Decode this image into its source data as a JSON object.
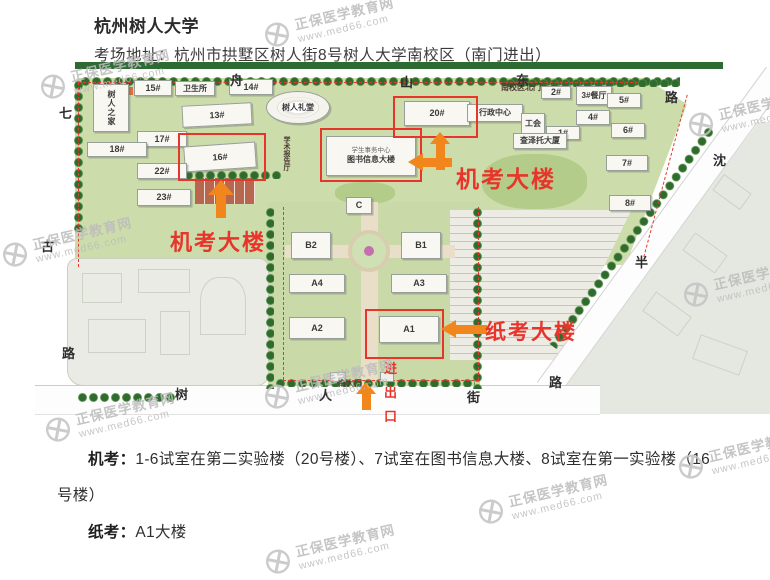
{
  "page": {
    "title": "杭州树人大学",
    "address": "考场地址：杭州市拱墅区树人街8号树人大学南校区（南门进出）"
  },
  "notes": {
    "jikao_label": "机考：",
    "jikao_text": "1-6试室在第二实验楼（20号楼）、7试室在图书信息大楼、8试室在第一实验楼（16号楼）",
    "zhikao_label": "纸考：",
    "zhikao_text": "A1大楼"
  },
  "watermark": {
    "line1": "正保医学教育网",
    "line2": "www.med66.com",
    "color": "#bcbcbc",
    "positions": [
      {
        "x": 262,
        "y": 6
      },
      {
        "x": 38,
        "y": 58
      },
      {
        "x": 686,
        "y": 96
      },
      {
        "x": 0,
        "y": 226
      },
      {
        "x": 681,
        "y": 266
      },
      {
        "x": 262,
        "y": 368
      },
      {
        "x": 43,
        "y": 401
      },
      {
        "x": 476,
        "y": 483
      },
      {
        "x": 676,
        "y": 438
      },
      {
        "x": 263,
        "y": 533
      }
    ]
  },
  "map": {
    "accent_red": "#e8352b",
    "accent_orange": "#f1861d",
    "road_labels": [
      {
        "t": "舟",
        "x": 195,
        "y": 8
      },
      {
        "t": "山",
        "x": 365,
        "y": 10
      },
      {
        "t": "东",
        "x": 481,
        "y": 8
      },
      {
        "t": "路",
        "x": 630,
        "y": 25
      },
      {
        "t": "七",
        "x": 24,
        "y": 41
      },
      {
        "t": "古",
        "x": 6,
        "y": 174
      },
      {
        "t": "路",
        "x": 27,
        "y": 281
      },
      {
        "t": "沈",
        "x": 678,
        "y": 88
      },
      {
        "t": "半",
        "x": 600,
        "y": 190
      },
      {
        "t": "路",
        "x": 514,
        "y": 310
      },
      {
        "t": "树",
        "x": 140,
        "y": 322
      },
      {
        "t": "人",
        "x": 284,
        "y": 323
      },
      {
        "t": "街",
        "x": 432,
        "y": 325
      }
    ],
    "tiny_labels": [
      {
        "t": "南校区北门",
        "x": 466,
        "y": 20
      },
      {
        "t": "南大门",
        "x": 303,
        "y": 316
      },
      {
        "t": "学术报告厅",
        "x": 246,
        "y": 74,
        "vert": true
      }
    ],
    "buildings": [
      {
        "label": "树人之家",
        "x": 58,
        "y": 22,
        "w": 36,
        "h": 48,
        "vert": true,
        "cn": true
      },
      {
        "label": "15#",
        "x": 99,
        "y": 18,
        "w": 38,
        "h": 16
      },
      {
        "label": "卫生所",
        "x": 140,
        "y": 19,
        "w": 40,
        "h": 15,
        "cn": true
      },
      {
        "label": "14#",
        "x": 194,
        "y": 17,
        "w": 44,
        "h": 16
      },
      {
        "label": "13#",
        "x": 147,
        "y": 42,
        "w": 70,
        "h": 22,
        "tilt": -3
      },
      {
        "label": "17#",
        "x": 102,
        "y": 69,
        "w": 50,
        "h": 16
      },
      {
        "label": "18#",
        "x": 52,
        "y": 80,
        "w": 60,
        "h": 15
      },
      {
        "label": "16#",
        "x": 149,
        "y": 82,
        "w": 72,
        "h": 26,
        "tilt": -4
      },
      {
        "label": "22#",
        "x": 102,
        "y": 101,
        "w": 50,
        "h": 16
      },
      {
        "label": "23#",
        "x": 102,
        "y": 127,
        "w": 54,
        "h": 17
      },
      {
        "label": "树人礼堂",
        "x": 231,
        "y": 29,
        "w": 64,
        "h": 33,
        "ellipse": true,
        "cn": true
      },
      {
        "label": "图书信息大楼",
        "sub": "学生事务中心",
        "x": 291,
        "y": 74,
        "w": 90,
        "h": 40,
        "cn": true
      },
      {
        "label": "20#",
        "x": 369,
        "y": 39,
        "w": 66,
        "h": 25
      },
      {
        "label": "行政中心",
        "x": 432,
        "y": 42,
        "w": 56,
        "h": 18,
        "cn": true
      },
      {
        "label": "工会",
        "x": 486,
        "y": 51,
        "w": 24,
        "h": 22,
        "cn": true
      },
      {
        "label": "2#",
        "x": 506,
        "y": 24,
        "w": 30,
        "h": 13
      },
      {
        "label": "3#餐厅",
        "x": 541,
        "y": 24,
        "w": 36,
        "h": 19,
        "cn": true
      },
      {
        "label": "5#",
        "x": 572,
        "y": 31,
        "w": 34,
        "h": 15
      },
      {
        "label": "4#",
        "x": 541,
        "y": 48,
        "w": 34,
        "h": 15
      },
      {
        "label": "1#",
        "x": 511,
        "y": 64,
        "w": 34,
        "h": 14
      },
      {
        "label": "查泽托大厦",
        "x": 478,
        "y": 71,
        "w": 54,
        "h": 16,
        "cn": true
      },
      {
        "label": "6#",
        "x": 576,
        "y": 61,
        "w": 34,
        "h": 15
      },
      {
        "label": "7#",
        "x": 571,
        "y": 93,
        "w": 42,
        "h": 16
      },
      {
        "label": "8#",
        "x": 574,
        "y": 133,
        "w": 42,
        "h": 16
      },
      {
        "label": "C",
        "x": 311,
        "y": 135,
        "w": 26,
        "h": 17
      },
      {
        "label": "B2",
        "x": 256,
        "y": 170,
        "w": 40,
        "h": 27
      },
      {
        "label": "B1",
        "x": 366,
        "y": 170,
        "w": 40,
        "h": 27
      },
      {
        "label": "A4",
        "x": 254,
        "y": 212,
        "w": 56,
        "h": 19
      },
      {
        "label": "A3",
        "x": 356,
        "y": 212,
        "w": 56,
        "h": 19
      },
      {
        "label": "A2",
        "x": 254,
        "y": 255,
        "w": 56,
        "h": 22
      },
      {
        "label": "A1",
        "x": 344,
        "y": 254,
        "w": 60,
        "h": 27
      }
    ],
    "red_boxes": [
      {
        "name": "highlight-16",
        "x": 143,
        "y": 71,
        "w": 84,
        "h": 44
      },
      {
        "name": "highlight-20",
        "x": 358,
        "y": 34,
        "w": 81,
        "h": 38
      },
      {
        "name": "highlight-library",
        "x": 285,
        "y": 66,
        "w": 98,
        "h": 50
      },
      {
        "name": "highlight-A1",
        "x": 330,
        "y": 247,
        "w": 75,
        "h": 46
      }
    ],
    "arrows": [
      {
        "dir": "up",
        "x": 173,
        "y": 118,
        "w": 26,
        "h": 38
      },
      {
        "dir": "up",
        "x": 395,
        "y": 70,
        "w": 20,
        "h": 38,
        "thin": true
      },
      {
        "dir": "left",
        "x": 373,
        "y": 91,
        "w": 44,
        "h": 18
      },
      {
        "dir": "left",
        "x": 406,
        "y": 258,
        "w": 46,
        "h": 18
      },
      {
        "dir": "up",
        "x": 321,
        "y": 320,
        "w": 20,
        "h": 28,
        "thin": true
      }
    ],
    "red_texts": [
      {
        "name": "jikao-note-1",
        "text": "机考大楼",
        "x": 135,
        "y": 163,
        "size": 22
      },
      {
        "name": "jikao-note-2",
        "text": "机考大楼",
        "x": 421,
        "y": 98,
        "size": 23
      },
      {
        "name": "zhikao-note",
        "text": "纸考大楼",
        "x": 450,
        "y": 254,
        "size": 21
      }
    ],
    "gate_text": {
      "text": "进出口",
      "x": 349,
      "y": 296
    }
  }
}
